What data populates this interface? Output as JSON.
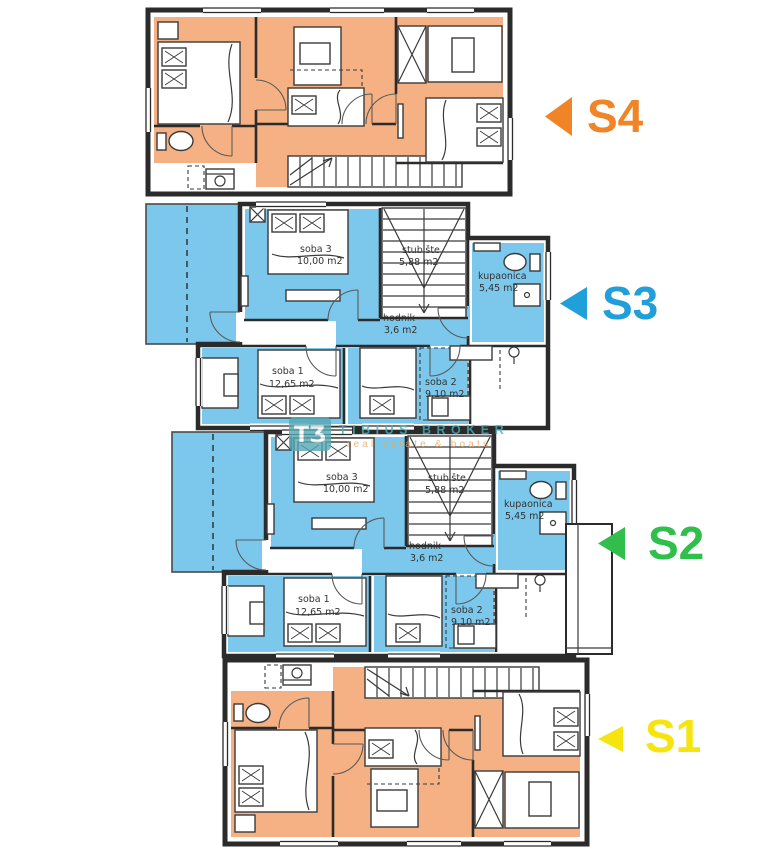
{
  "page": {
    "background": "#ffffff"
  },
  "colors": {
    "wall": "#2b2b2b",
    "furniture_stroke": "#3a3a3a",
    "s4_fill": "#f5b183",
    "s4_accent": "#f08427",
    "s3_fill": "#7bc8ec",
    "s3_accent": "#219fd9",
    "s2_fill": "#90dda4",
    "s2_accent": "#2fbf4a",
    "s1_fill": "#f2e87d",
    "s1_accent": "#f6e40e",
    "watermark_teal": "#55a8b4",
    "watermark_text": "#49aebe",
    "watermark_orange": "#eaa763"
  },
  "apartments": [
    {
      "id": "s4",
      "label": "S4"
    },
    {
      "id": "s3",
      "label": "S3",
      "rooms": [
        {
          "name": "soba 3",
          "area": "10,00 m2"
        },
        {
          "name": "stubište",
          "area": "5,88 m2"
        },
        {
          "name": "kupaonica",
          "area": "5,45 m2"
        },
        {
          "name": "hodnik",
          "area": "3,6 m2"
        },
        {
          "name": "soba 1",
          "area": "12,65 m2"
        },
        {
          "name": "soba 2",
          "area": "9,10 m2"
        }
      ]
    },
    {
      "id": "s2",
      "label": "S2",
      "rooms": [
        {
          "name": "soba 3",
          "area": "10,00 m2"
        },
        {
          "name": "stubište",
          "area": "5,88 m2"
        },
        {
          "name": "kupaonica",
          "area": "5,45 m2"
        },
        {
          "name": "hodnik",
          "area": "3,6 m2"
        },
        {
          "name": "soba 1",
          "area": "12,65 m2"
        },
        {
          "name": "soba 2",
          "area": "9,10 m2"
        }
      ]
    },
    {
      "id": "s1",
      "label": "S1"
    }
  ],
  "watermark": {
    "monogram": "TƷ",
    "brand": "TIBIUS BROKER",
    "tagline": "real estate & boats"
  }
}
